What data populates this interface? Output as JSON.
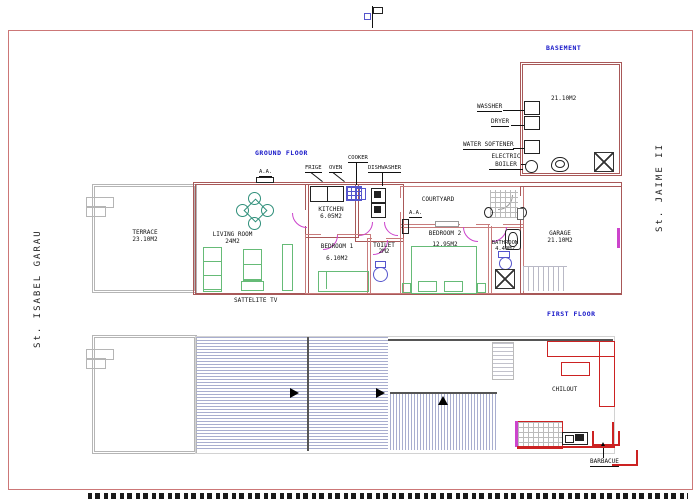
{
  "streets": {
    "left": "St. ISABEL GARAU",
    "right": "St. JAIME II"
  },
  "titles": {
    "basement": "BASEMENT",
    "ground": "GROUND FLOOR",
    "first": "FIRST FLOOR"
  },
  "basement": {
    "area": "21.10M2",
    "washer": "WASSHER",
    "dryer": "DRYER",
    "water_softener": "WATER SOFTENER",
    "electric_boiler": "ELECTRIC BOILER"
  },
  "ground": {
    "terrace": {
      "name": "TERRACE",
      "area": "23.10M2"
    },
    "living_room": {
      "name": "LIVING ROOM",
      "area": "24M2"
    },
    "kitchen": {
      "name": "KITCHEN",
      "area": "6.05M2"
    },
    "bedroom1": {
      "name": "BEDROOM 1",
      "area": "6.10M2"
    },
    "toilet": {
      "name": "TOILET",
      "area": "2M2"
    },
    "courtyard": {
      "name": "COURTYARD"
    },
    "bedroom2": {
      "name": "BEDROOM 2",
      "area": "12.95M2"
    },
    "bathroom": {
      "name": "BATHROOM",
      "area": "4.40M2"
    },
    "garage": {
      "name": "GARAGE",
      "area": "21.10M2"
    },
    "appliances": {
      "fridge": "FRIGE",
      "oven": "OVEN",
      "cooker": "COOKER",
      "dishwasher": "DISHWASHER"
    },
    "ac": "A.A.",
    "satellite": "SATTELITE TV"
  },
  "first": {
    "chillout": "CHILOUT",
    "barbecue": "BARBACUE"
  },
  "colors": {
    "wall": "#a85858",
    "wall_light": "#c87c7c",
    "door": "#cc44cc",
    "furniture": "#66bb77",
    "dining": "#2f8f7a",
    "fixture": "#5555cc",
    "title": "#1515c8",
    "hatch": "#a9aecf",
    "terrace": "#b5b5b5",
    "red": "#cc2222",
    "frame": "#cc7777"
  }
}
